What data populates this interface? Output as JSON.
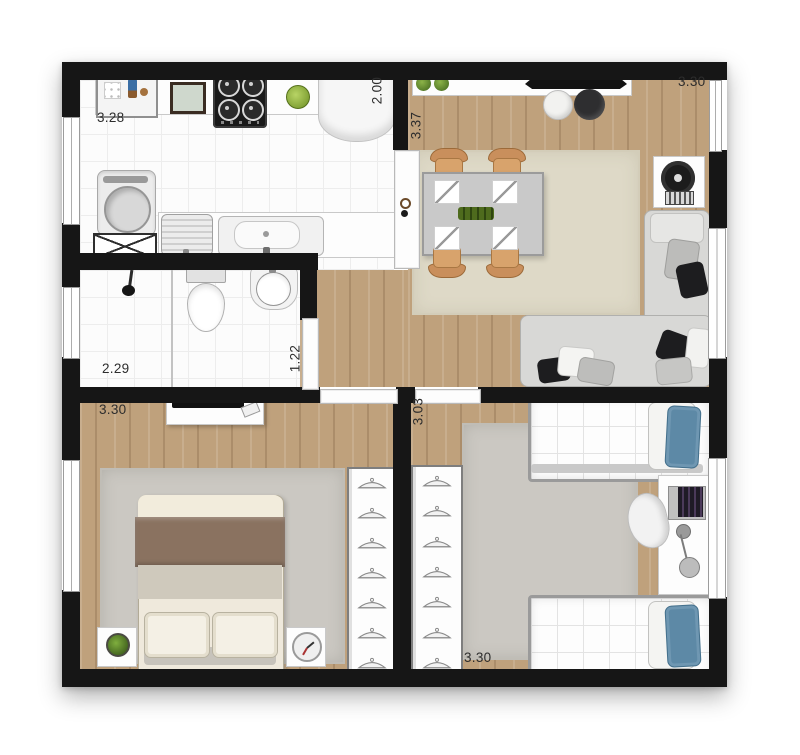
{
  "floor_plan": {
    "description": "Top-view apartment floor plan: kitchen with laundry, living-dining room, bathroom, hallway and two bedrooms",
    "unit": "meters",
    "dimensions": {
      "kitchen_width": "3.28",
      "kitchen_depth": "2.00",
      "living_width": "3.30",
      "living_depth": "3.37",
      "bathroom_width": "2.29",
      "bathroom_depth": "1.22",
      "bedroom_main_width": "3.30",
      "bedroom_second_depth": "3.03",
      "bedroom_second_width": "3.30"
    },
    "rooms": [
      {
        "name": "kitchen-laundry",
        "items": [
          "counter with dish rack",
          "microwave",
          "four-burner cooktop",
          "fruit bowl",
          "refrigerator",
          "washing machine",
          "duct shaft",
          "laundry tank",
          "kitchen sink"
        ]
      },
      {
        "name": "living-dining",
        "items": [
          "sideboard with two plants",
          "wall tv",
          "white pouf",
          "black pouf",
          "dining table for four",
          "four place settings",
          "green centerpiece",
          "beige rug",
          "l-shaped sofa with cushions",
          "fan on stand"
        ]
      },
      {
        "name": "bathroom",
        "items": [
          "shower with glass partition",
          "toilet",
          "washbasin"
        ]
      },
      {
        "name": "hallway",
        "items": [
          "bathroom door",
          "bedroom doors"
        ]
      },
      {
        "name": "main-bedroom",
        "items": [
          "dresser with tv",
          "double bed with brown blanket",
          "nightstand with plant",
          "nightstand with clock",
          "gray rug",
          "open wardrobe with hangers"
        ]
      },
      {
        "name": "second-bedroom",
        "items": [
          "single bed with blue pillow (top)",
          "single bed with blue pillow (bottom)",
          "desk with laptop",
          "office chair",
          "floor lamp",
          "gray rug",
          "open wardrobe with hangers"
        ]
      }
    ],
    "colors": {
      "wall": "#161616",
      "wood_floor": "#bfa17c",
      "tile_floor": "#fcfcfc",
      "living_rug": "#ded9c7",
      "bedroom_rug": "#cbc8c2",
      "blanket_brown": "#8a7260",
      "pillow_blue": "#5d89a6",
      "chair_wood": "#c98f5c",
      "plant_green": "#6f9a30",
      "sofa_gray": "#d8d8d6"
    }
  }
}
